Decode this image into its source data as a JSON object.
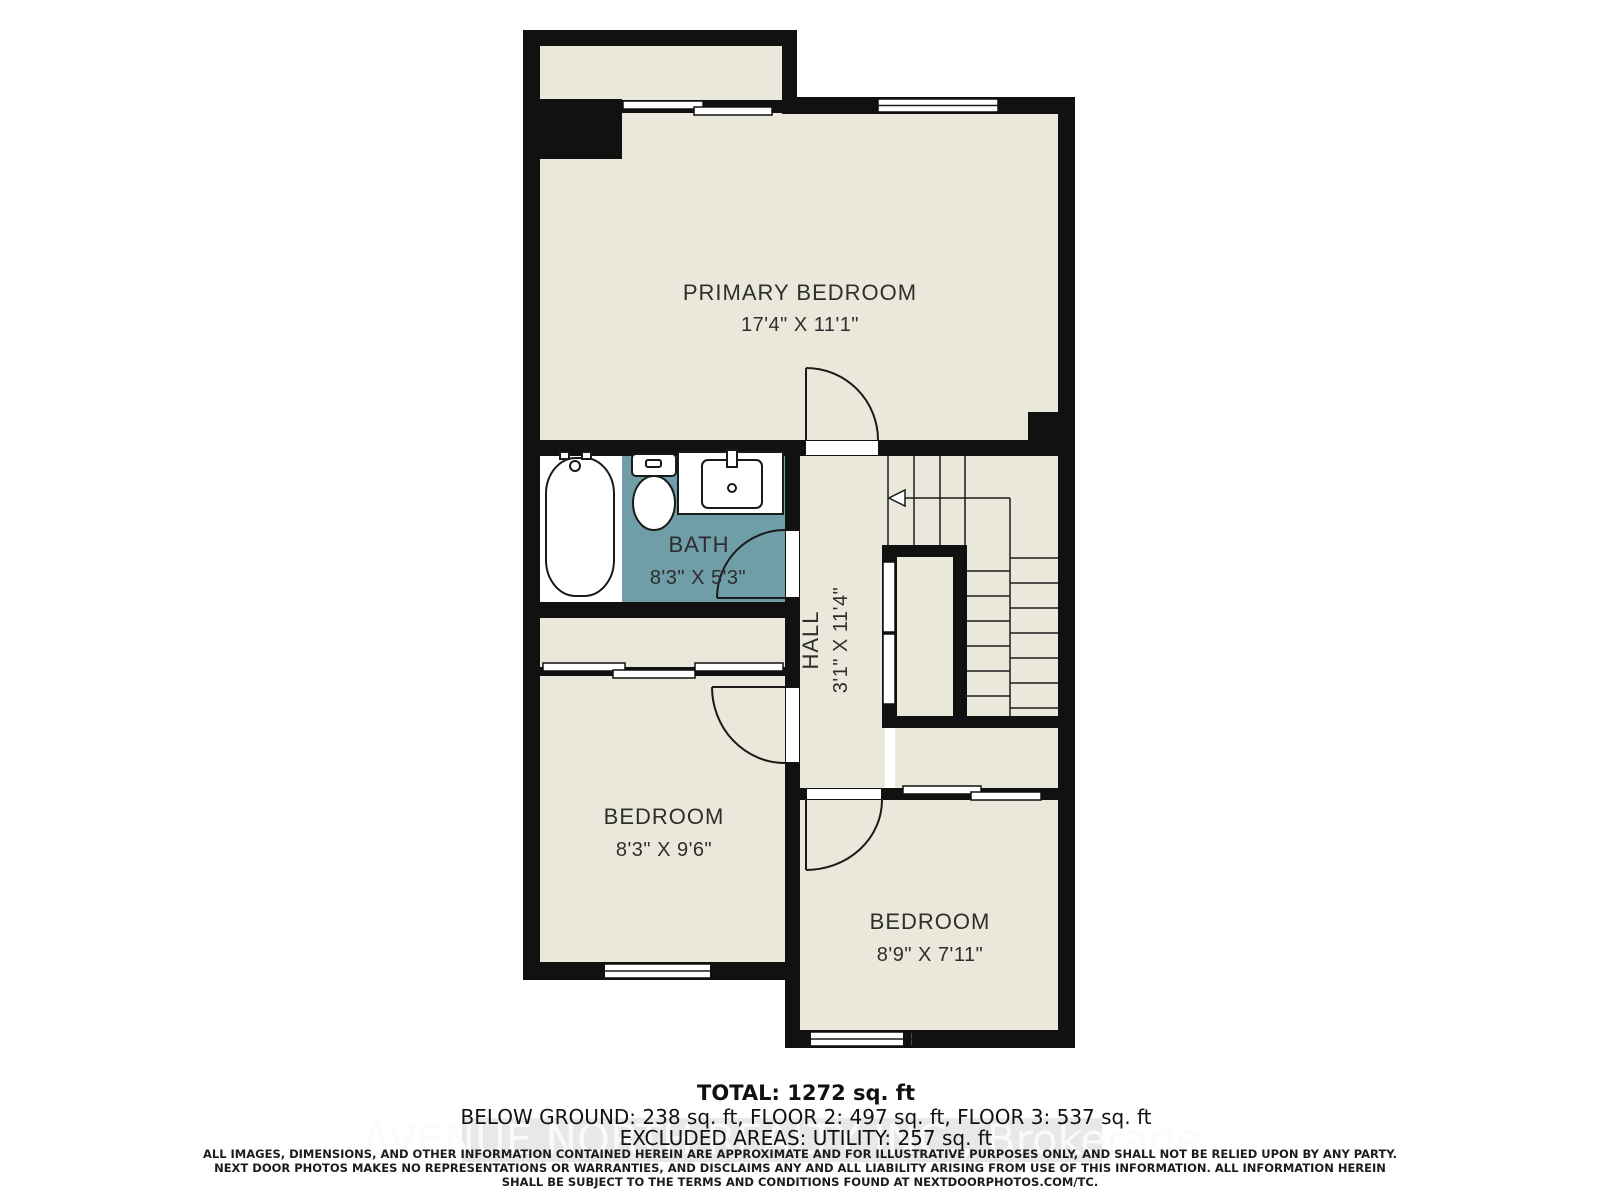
{
  "plan": {
    "rooms": {
      "primary_bedroom": {
        "name": "PRIMARY BEDROOM",
        "dims": "17'4\" X 11'1\""
      },
      "bath": {
        "name": "BATH",
        "dims": "8'3\" X 5'3\""
      },
      "hall": {
        "name": "HALL",
        "dims": "3'1\" X 11'4\""
      },
      "bedroom_left": {
        "name": "BEDROOM",
        "dims": "8'3\" X 9'6\""
      },
      "bedroom_right": {
        "name": "BEDROOM",
        "dims": "8'9\" X 7'11\""
      }
    },
    "stairs": {
      "direction_icon": "stairs-up-arrow"
    },
    "fixtures": [
      "bathtub",
      "toilet",
      "sink-vanity"
    ],
    "colors": {
      "floor": "#eae8db",
      "bath_floor": "#6f9da8",
      "wall": "#111111",
      "label": "#2e2e2e"
    }
  },
  "footer": {
    "total": "TOTAL: 1272 sq. ft",
    "floors": "BELOW GROUND: 238 sq. ft, FLOOR 2: 497 sq. ft, FLOOR 3: 537 sq. ft",
    "excluded": "EXCLUDED AREAS: UTILITY: 257 sq. ft",
    "watermark": "AVENUE NORTH REALTY INC., Brokerage",
    "disclaimer": [
      "ALL IMAGES, DIMENSIONS, AND OTHER INFORMATION CONTAINED HEREIN ARE APPROXIMATE AND FOR ILLUSTRATIVE PURPOSES ONLY, AND SHALL NOT BE RELIED UPON BY ANY PARTY.",
      "NEXT DOOR PHOTOS MAKES NO REPRESENTATIONS OR WARRANTIES, AND DISCLAIMS ANY AND ALL LIABILITY ARISING FROM USE OF THIS INFORMATION. ALL INFORMATION HEREIN",
      "SHALL BE SUBJECT TO THE TERMS AND CONDITIONS FOUND AT NEXTDOORPHOTOS.COM/TC."
    ]
  }
}
